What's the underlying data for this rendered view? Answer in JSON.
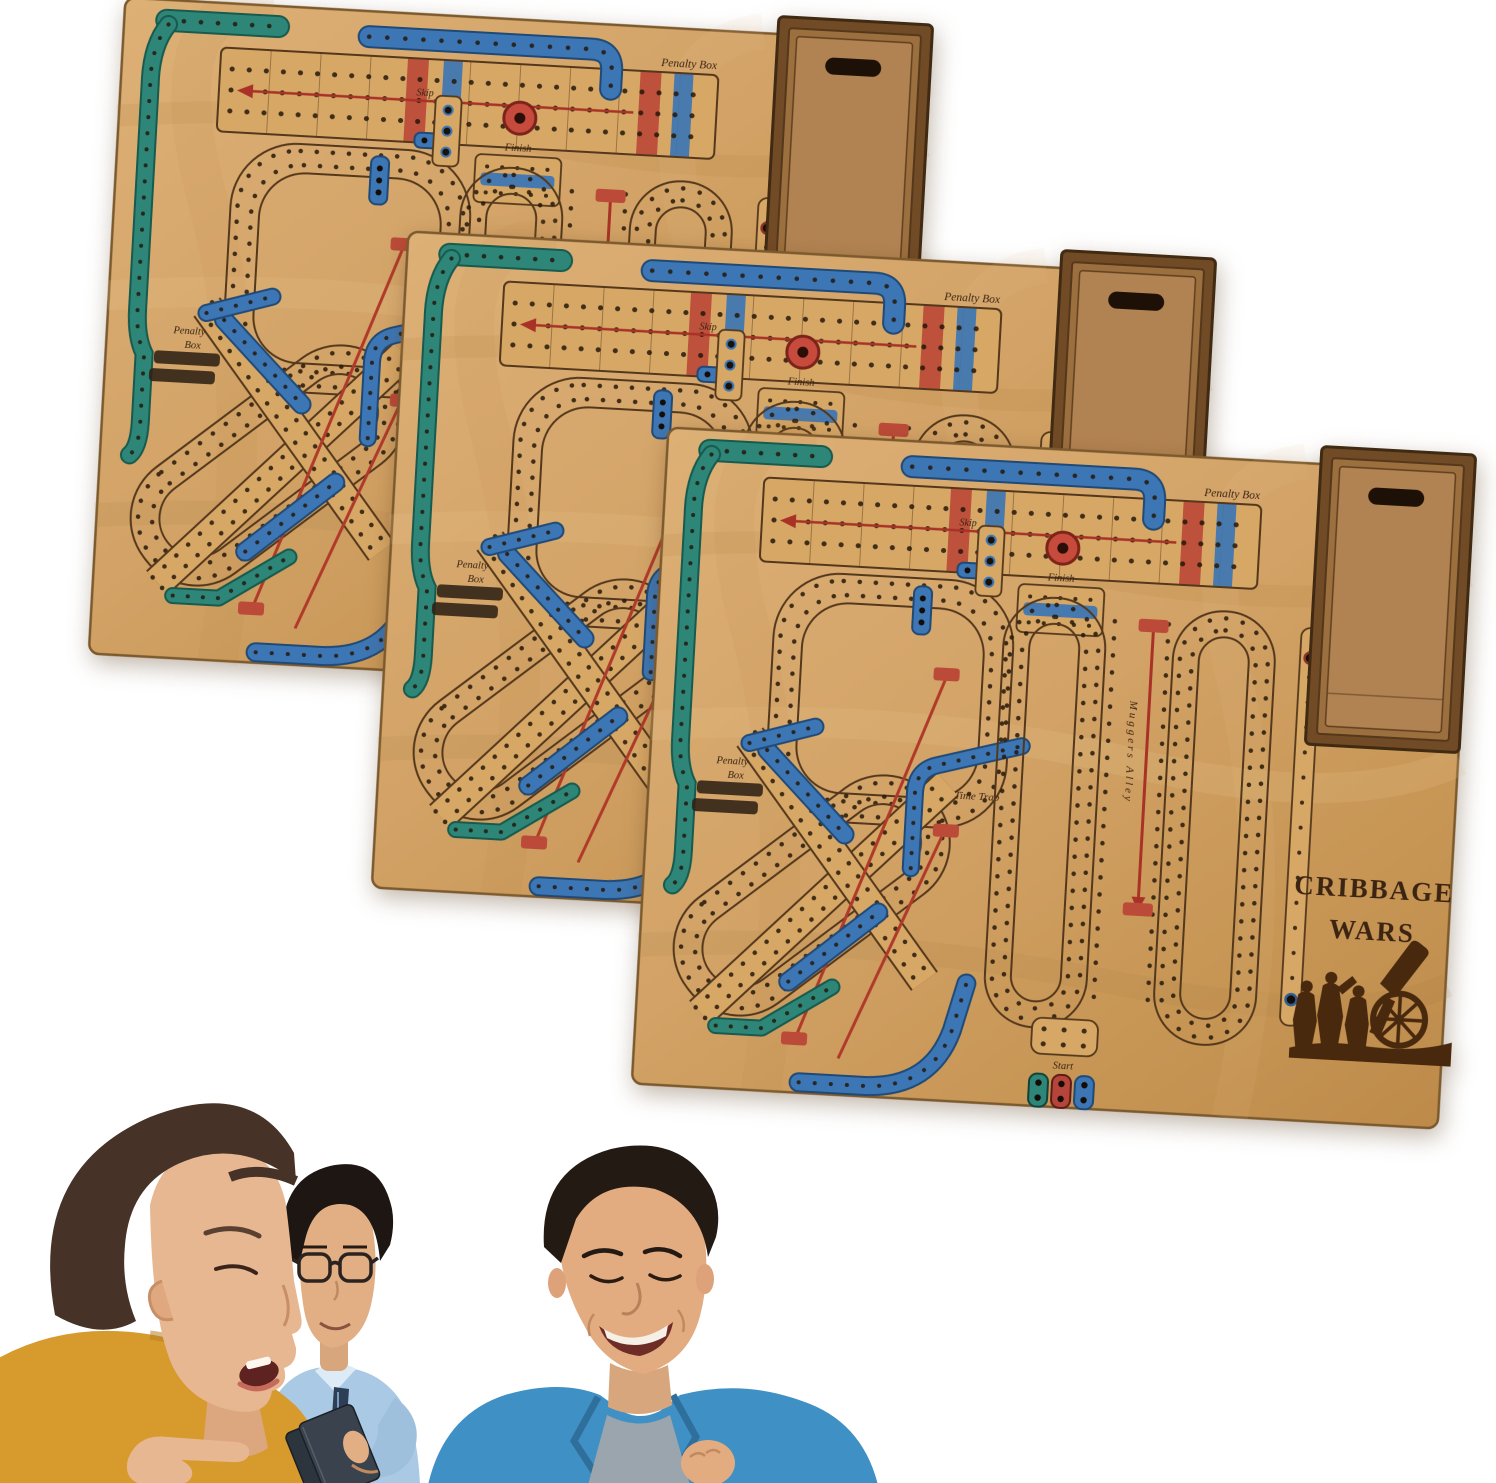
{
  "boards": {
    "count": 3,
    "title_line1": "CRIBBAGE",
    "title_line2": "WARS",
    "labels": {
      "penalty_box": "Penalty Box",
      "penalty": "Penalty",
      "box": "Box",
      "finish": "Finish",
      "skip": "Skip",
      "time_trap": "Time Trap",
      "muggers_alley": "Muggers Alley",
      "start": "Start"
    },
    "colors": {
      "wood": "#d2a266",
      "wood_track": "#d7a766",
      "teal_track": "#2d8678",
      "blue_track": "#3d76b4",
      "red_accent": "#b03a2a",
      "engraving": "#3b2412",
      "box_wood": "#9c6f3e",
      "hole": "#241709"
    }
  },
  "photo": {
    "people": [
      "woman-pointing",
      "man-with-glasses-holding-cards",
      "man-smiling-in-blue-jacket"
    ]
  }
}
